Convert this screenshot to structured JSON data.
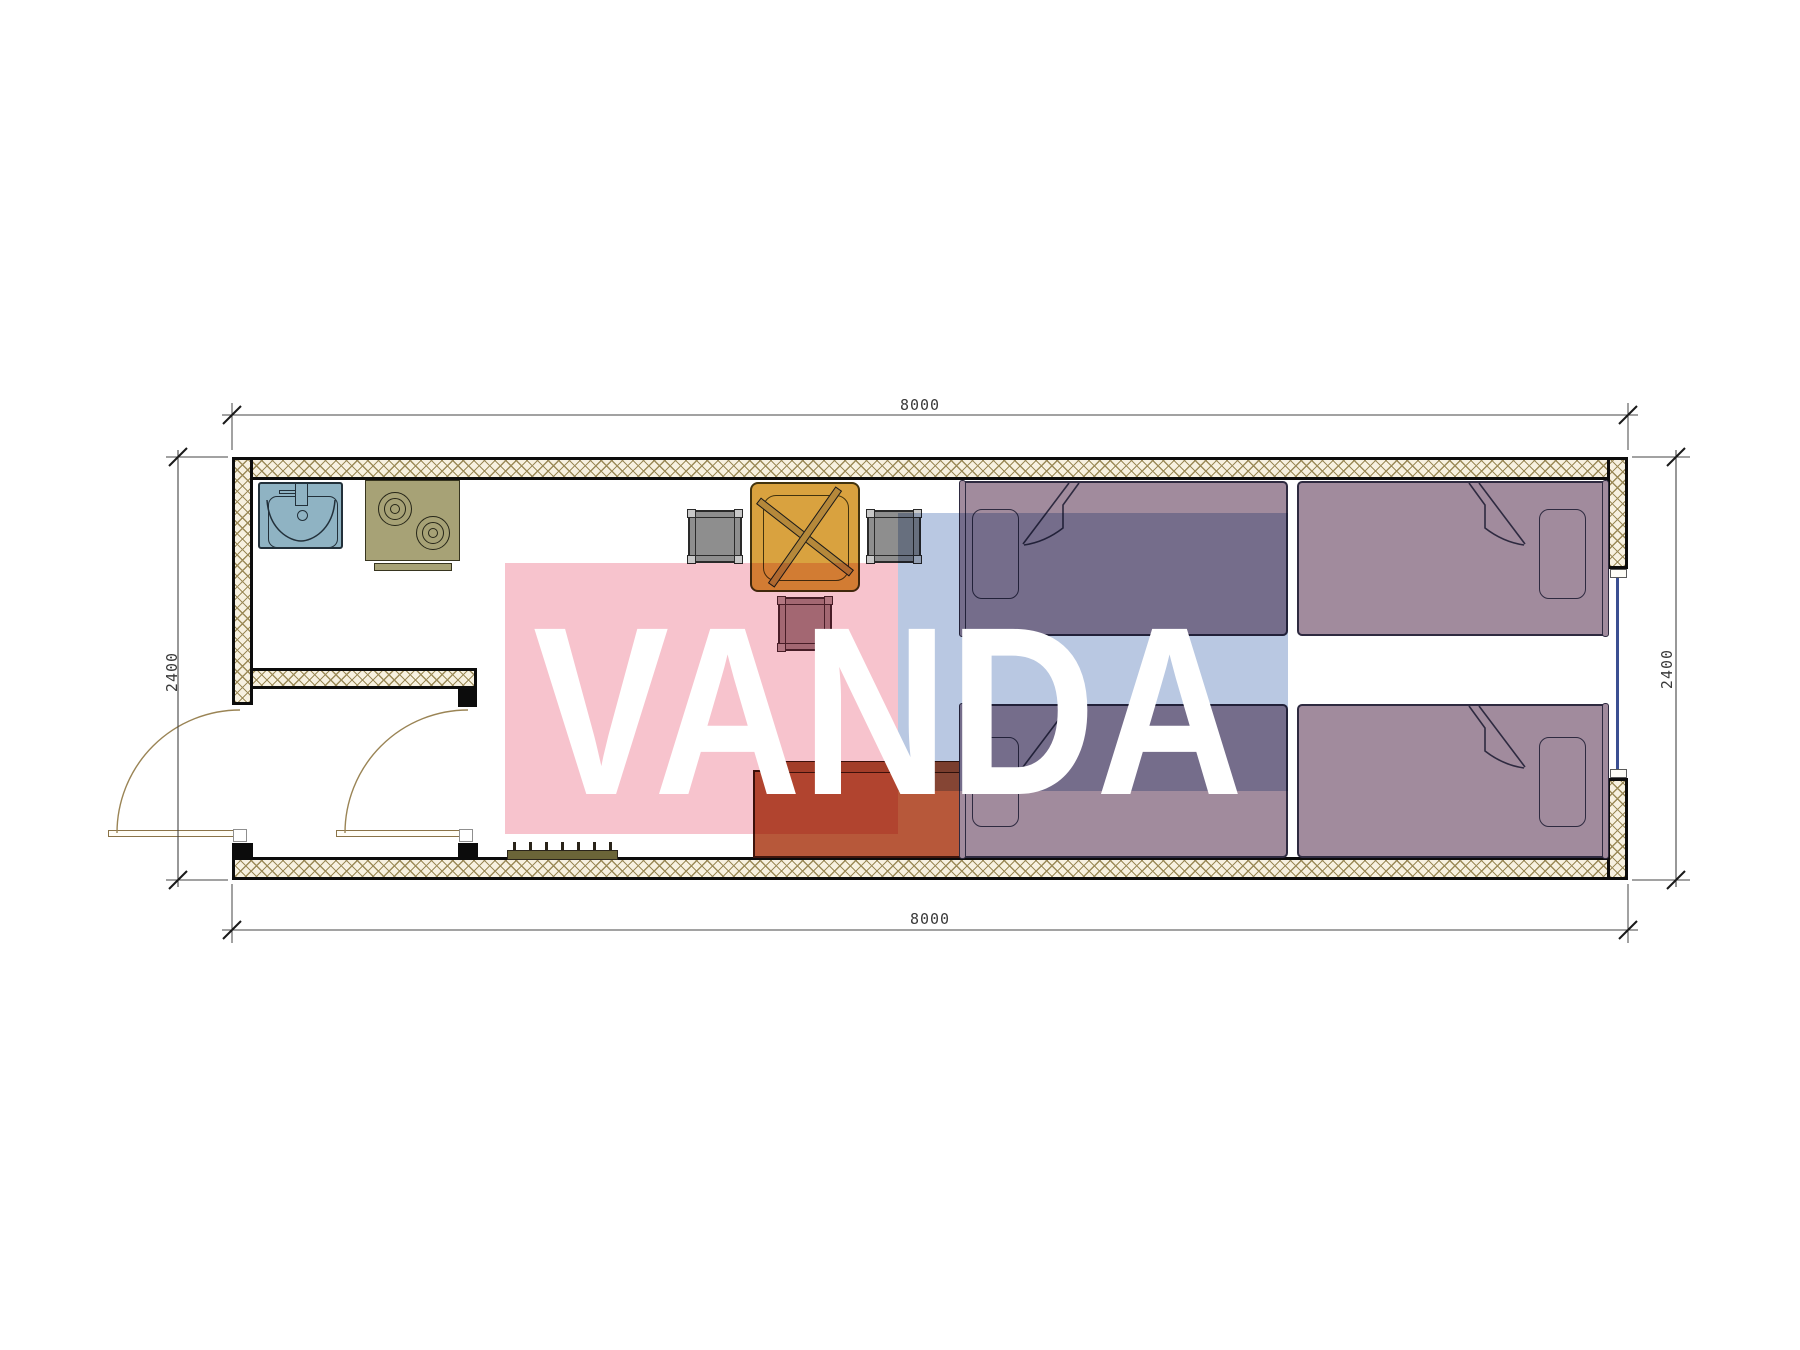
{
  "meta": {
    "title": "Container house floor plan",
    "plan_type": "architectural floor plan, top view",
    "overall_size_mm": {
      "width": "8000",
      "height": "2400"
    }
  },
  "dimensions": {
    "top": "8000",
    "bottom": "8000",
    "left": "2400",
    "right": "2400"
  },
  "watermark": {
    "text": "VANDA",
    "pink_color": "#f7c3cd",
    "blue_color": "#b9c8e2",
    "text_color": "#ffffff"
  },
  "rooms": [
    {
      "name": "kitchenette",
      "position": "top-left"
    },
    {
      "name": "entry-vestibule",
      "position": "bottom-left"
    },
    {
      "name": "living-sleeping-area",
      "position": "center-right"
    }
  ],
  "doors": [
    {
      "name": "entry-door",
      "location": "left wall",
      "swing": "outward"
    },
    {
      "name": "vestibule-door",
      "location": "vestibule to living area",
      "swing": "into vestibule"
    }
  ],
  "windows": [
    {
      "name": "right-wall-window",
      "location": "right wall, centered between bed rows"
    }
  ],
  "furniture": [
    {
      "name": "kitchen-sink",
      "color": "#8fb3c3"
    },
    {
      "name": "two-burner-stove",
      "color": "#a7a276"
    },
    {
      "name": "dining-table",
      "color": "#d9a23f"
    },
    {
      "name": "chair-left",
      "color": "#8e8e8e"
    },
    {
      "name": "chair-right",
      "color": "#8e8e8e"
    },
    {
      "name": "stool",
      "color": "#a8868e"
    },
    {
      "name": "sofa",
      "color": "#b7583a",
      "cushions": 3
    },
    {
      "name": "bed-top-left",
      "color": "#a18b9d"
    },
    {
      "name": "bed-top-right",
      "color": "#a18b9d"
    },
    {
      "name": "bed-bottom-left",
      "color": "#a18b9d"
    },
    {
      "name": "bed-bottom-right",
      "color": "#a18b9d"
    },
    {
      "name": "shoe-grate",
      "color": "#6b6538"
    }
  ],
  "colors": {
    "wall_hatch_line": "#9b8a58",
    "wall_hatch_bg": "#f7f1e0",
    "wall_border": "#0c0c0c",
    "door_line": "#8a7348",
    "window_glazing": "#3b4f92",
    "dimension_line": "#444444"
  }
}
